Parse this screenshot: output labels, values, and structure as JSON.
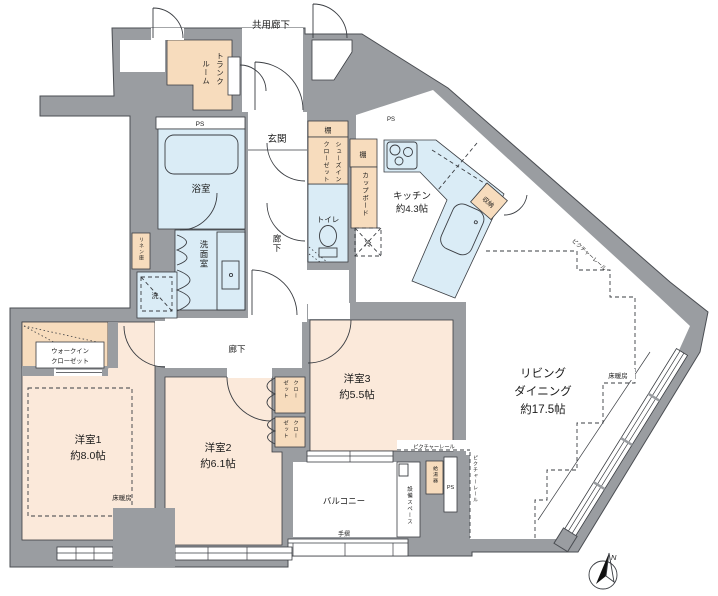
{
  "palette": {
    "wall": "#9a9da1",
    "wall_edge": "#4a4d52",
    "line": "#3a3d42",
    "room_peach": "#fbe9da",
    "storage_peach": "#f7dcbd",
    "wet_blue": "#daecf6",
    "white": "#ffffff",
    "text": "#1b1b1b"
  },
  "labels": {
    "common_corridor": "共用廊下",
    "trunk_room_col1": "トランク",
    "trunk_room_col2": "ルーム",
    "ps": "PS",
    "entrance": "玄関",
    "bathroom": "浴室",
    "washroom": "洗面室",
    "linen": "リネン庫",
    "washer": "洗",
    "toilet": "トイレ",
    "shelf": "棚",
    "shoes_closet_col1": "シューズイン",
    "shoes_closet_col2": "クローゼット",
    "cupboard": "カップボード",
    "fridge": "冷",
    "storage": "収納",
    "hallway": "廊下",
    "kitchen_name": "キッチン",
    "kitchen_size": "約4.3帖",
    "living_name1": "リビング",
    "living_name2": "ダイニング",
    "living_size": "約17.5帖",
    "bedroom1_name": "洋室1",
    "bedroom1_size": "約8.0帖",
    "bedroom2_name": "洋室2",
    "bedroom2_size": "約6.1帖",
    "bedroom3_name": "洋室3",
    "bedroom3_size": "約5.5帖",
    "wic_line1": "ウォークイン",
    "wic_line2": "クローゼット",
    "closet_col1": "クロー",
    "closet_col2": "ゼット",
    "balcony": "バルコニー",
    "handrail": "手摺",
    "equipment_space": "設備スペース",
    "water_heater": "給湯器",
    "floor_heating": "床暖房",
    "picture_rail": "ピクチャーレール",
    "compass_north": "N"
  }
}
